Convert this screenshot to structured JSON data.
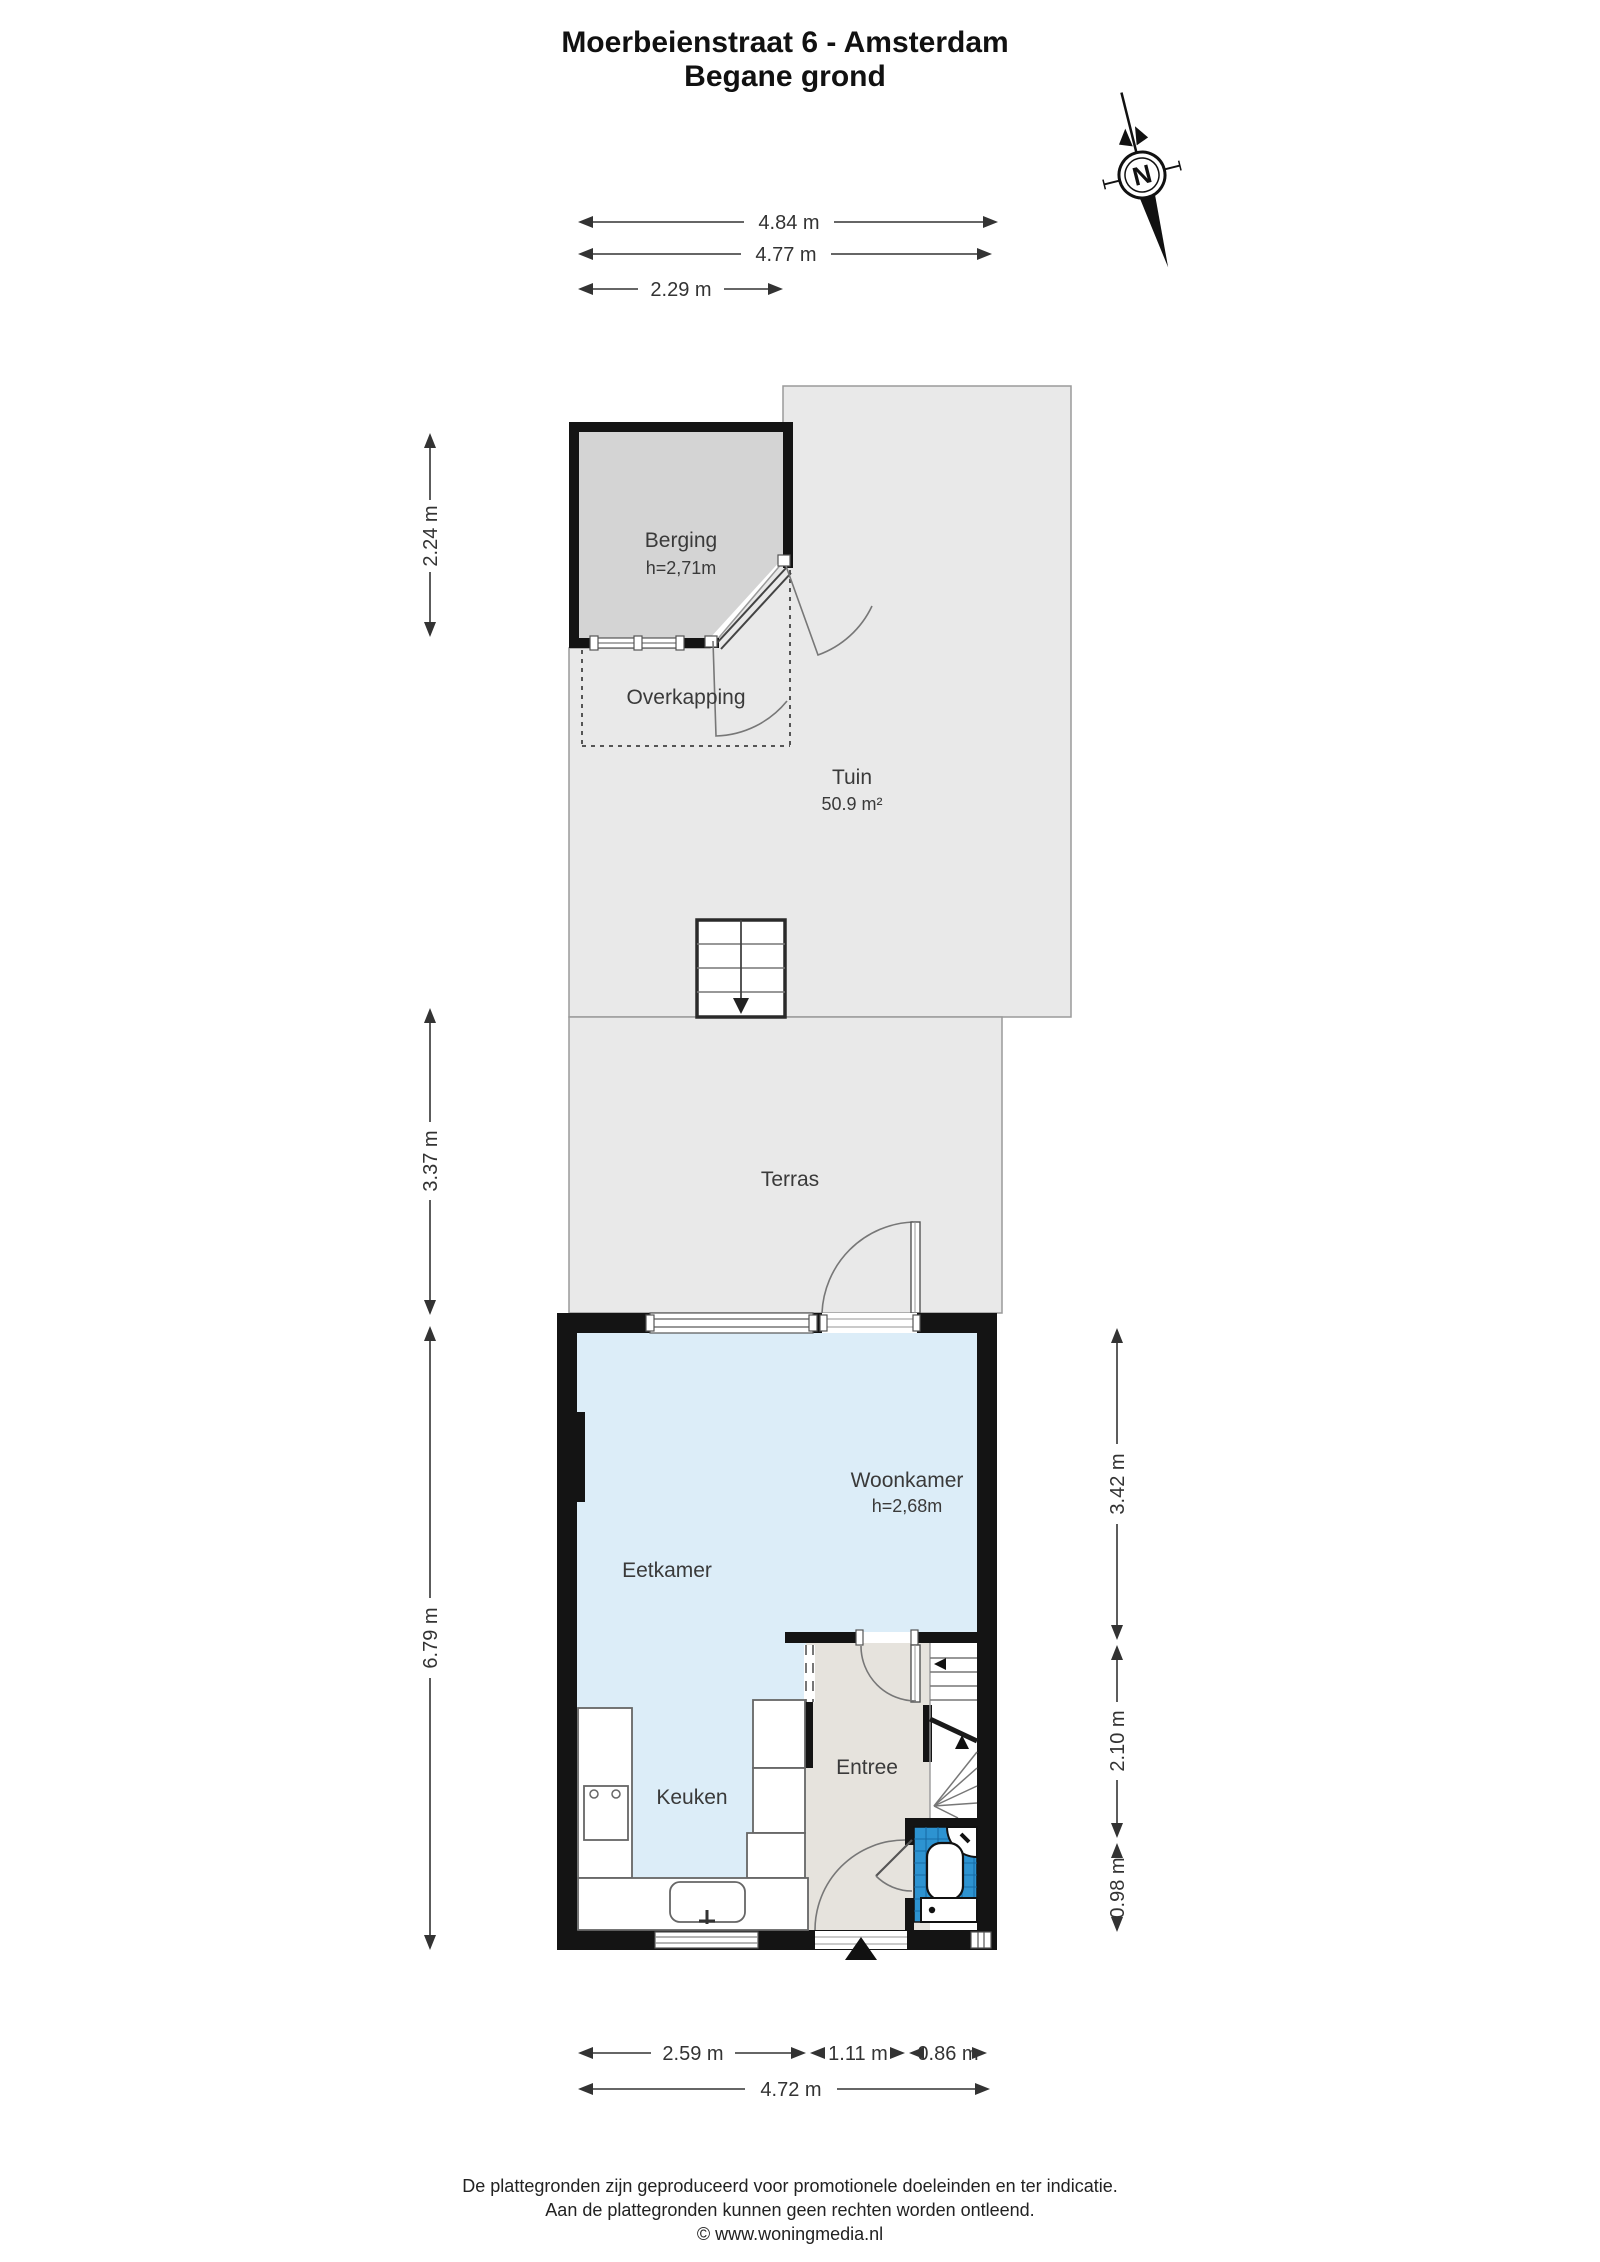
{
  "title": {
    "line1": "Moerbeienstraat 6 - Amsterdam",
    "line2": "Begane grond"
  },
  "compass": {
    "label": "N"
  },
  "rooms": {
    "berging": {
      "name": "Berging",
      "ceiling": "h=2,71m"
    },
    "overkapping": {
      "name": "Overkapping"
    },
    "tuin": {
      "name": "Tuin",
      "area": "50.9 m²"
    },
    "terras": {
      "name": "Terras"
    },
    "woonkamer": {
      "name": "Woonkamer",
      "ceiling": "h=2,68m"
    },
    "eetkamer": {
      "name": "Eetkamer"
    },
    "keuken": {
      "name": "Keuken"
    },
    "entree": {
      "name": "Entree"
    }
  },
  "dimensions": {
    "top": [
      "4.84 m",
      "4.77 m",
      "2.29 m"
    ],
    "left": [
      "2.24 m",
      "3.37 m",
      "6.79 m"
    ],
    "right": [
      "3.42 m",
      "2.10 m",
      "0.98 m"
    ],
    "bottom_segments": [
      "2.59 m",
      "1.11 m",
      "0.86 m"
    ],
    "bottom_total": "4.72 m"
  },
  "footer": {
    "line1": "De plattegronden zijn geproduceerd voor promotionele doeleinden en ter indicatie.",
    "line2": "Aan de plattegronden kunnen geen rechten worden ontleend.",
    "line3": "© www.woningmedia.nl"
  },
  "colors": {
    "wall": "#141414",
    "outdoor_gray": "#e9e9e9",
    "berging_gray": "#d4d4d4",
    "interior_blue": "#dcedf8",
    "entree_floor": "#e6e3dd",
    "toilet_tile_blue": "#2d93d1",
    "dimension_text": "#333333"
  }
}
